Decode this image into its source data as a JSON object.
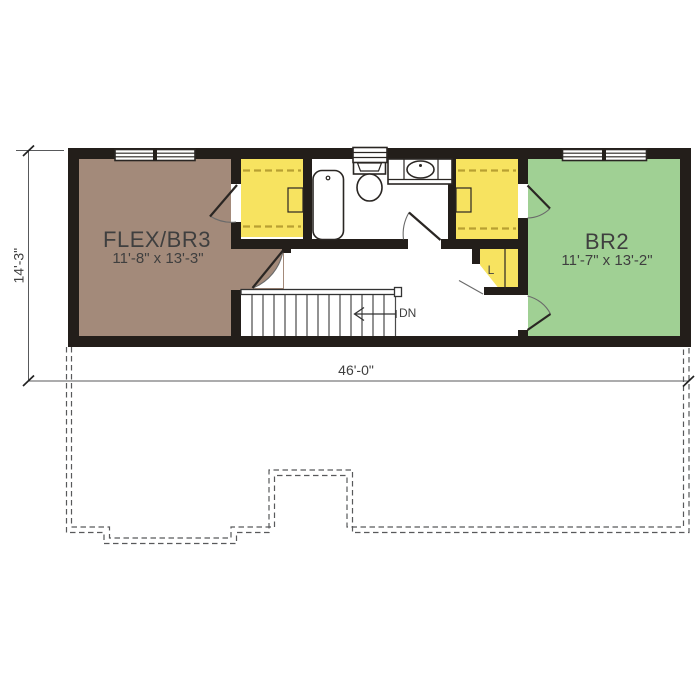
{
  "rooms": {
    "flex": {
      "name": "FLEX/BR3",
      "dims": "11'-8\" x 13'-3\""
    },
    "br2": {
      "name": "BR2",
      "dims": "11'-7\" x 13'-2\""
    },
    "linen": {
      "label": "L"
    }
  },
  "stairs": {
    "down_label": "DN"
  },
  "dimensions": {
    "left_height": "14'-3\"",
    "bottom_width": "46'-0\""
  },
  "colors": {
    "wall": "#231e1a",
    "room_flex": "#a38a7a",
    "room_br2": "#a0d094",
    "closet": "#f7e360",
    "shelf_line": "#b8a032",
    "dim_line": "#58595b",
    "text": "#3f3f3f"
  }
}
